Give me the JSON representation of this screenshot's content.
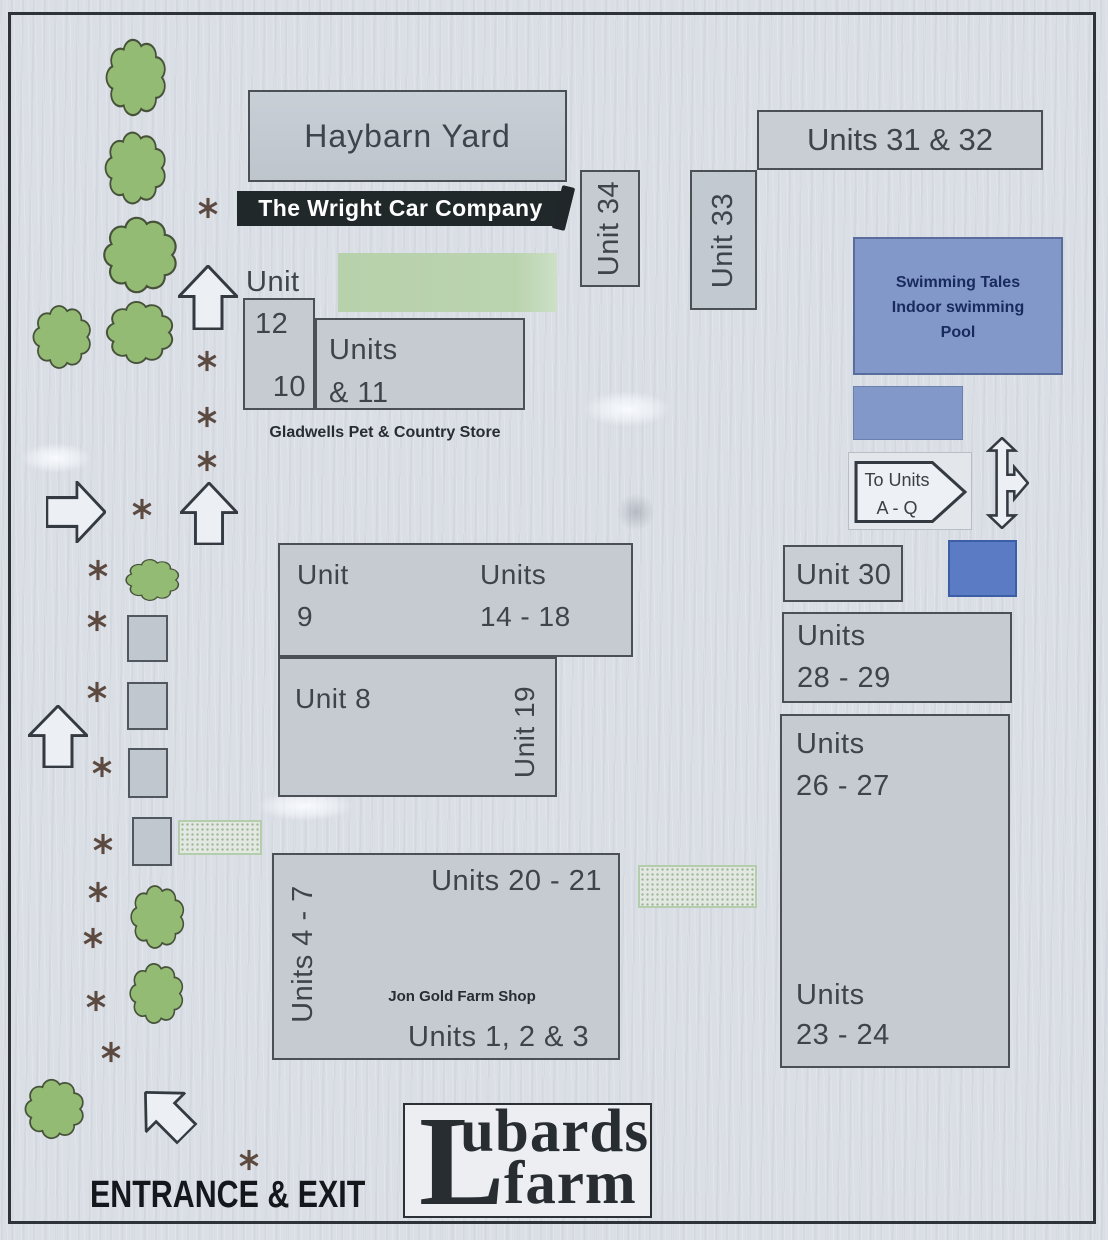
{
  "buildings": {
    "haybarn": {
      "label": "Haybarn Yard"
    },
    "wright_car": {
      "label": "The Wright Car Company"
    },
    "unit12": {
      "title": "Unit",
      "number_top": "12",
      "number_bottom": "10"
    },
    "units10_11": {
      "line1": "Units",
      "line2": "& 11"
    },
    "gladwells": {
      "label": "Gladwells Pet & Country Store"
    },
    "unit34": {
      "label": "Unit 34"
    },
    "unit33": {
      "label": "Unit 33"
    },
    "units31_32": {
      "label": "Units 31 & 32"
    },
    "pool": {
      "line1": "Swimming Tales",
      "line2": "Indoor swimming",
      "line3": "Pool"
    },
    "to_units_sign": {
      "line1": "To Units",
      "line2": "A - Q"
    },
    "unit30": {
      "label": "Unit 30"
    },
    "units28_29": {
      "line1": "Units",
      "line2": "28 - 29"
    },
    "units26_27": {
      "line1": "Units",
      "line2": "26 - 27"
    },
    "units23_24": {
      "line1": "Units",
      "line2": "23 - 24"
    },
    "unit9": {
      "line1": "Unit",
      "line2": "9"
    },
    "units14_18": {
      "line1": "Units",
      "line2": "14 - 18"
    },
    "unit8": {
      "label": "Unit 8"
    },
    "unit19": {
      "label": "Unit 19"
    },
    "units20_21": {
      "label": "Units 20 - 21"
    },
    "units4_7": {
      "label": "Units 4 - 7"
    },
    "jon_gold": {
      "label": "Jon Gold Farm Shop"
    },
    "units1_2_3": {
      "label": "Units 1, 2 & 3"
    },
    "entrance": {
      "label": "ENTRANCE & EXIT"
    },
    "logo": {
      "initial": "L",
      "rest": "ubards",
      "word2": "farm",
      "full_name": "Lubards farm"
    }
  },
  "colors": {
    "background": "#dadee5",
    "box_fill": "#c6cbd2",
    "box_border": "#4a5056",
    "banner_bg": "#212829",
    "banner_text": "#ffffff",
    "green_area": "#b9d3ae",
    "tree_fill": "#93bb74",
    "tree_stroke": "#47523a",
    "pool_fill": "#8298c8",
    "pool_text": "#192a5c",
    "blue_square": "#5b7cc4",
    "blue_box": "#8298c8",
    "asterisk": "#5c4a41",
    "arrow_stroke": "#343a41",
    "arrow_fill": "#eceff3",
    "text": "#3e444b"
  },
  "decorations": {
    "trees": [
      {
        "x": 103,
        "y": 35,
        "w": 67,
        "h": 85
      },
      {
        "x": 102,
        "y": 128,
        "w": 68,
        "h": 80
      },
      {
        "x": 100,
        "y": 213,
        "w": 82,
        "h": 84
      },
      {
        "x": 30,
        "y": 302,
        "w": 65,
        "h": 70
      },
      {
        "x": 103,
        "y": 298,
        "w": 75,
        "h": 69
      },
      {
        "x": 123,
        "y": 557,
        "w": 60,
        "h": 46
      },
      {
        "x": 128,
        "y": 882,
        "w": 60,
        "h": 70
      },
      {
        "x": 127,
        "y": 960,
        "w": 60,
        "h": 67
      },
      {
        "x": 22,
        "y": 1076,
        "w": 66,
        "h": 66
      }
    ],
    "asterisks": [
      {
        "x": 208,
        "y": 208
      },
      {
        "x": 207,
        "y": 361
      },
      {
        "x": 207,
        "y": 417
      },
      {
        "x": 207,
        "y": 461
      },
      {
        "x": 142,
        "y": 509
      },
      {
        "x": 98,
        "y": 570
      },
      {
        "x": 97,
        "y": 621
      },
      {
        "x": 97,
        "y": 692
      },
      {
        "x": 102,
        "y": 767
      },
      {
        "x": 103,
        "y": 844
      },
      {
        "x": 98,
        "y": 892
      },
      {
        "x": 93,
        "y": 938
      },
      {
        "x": 96,
        "y": 1001
      },
      {
        "x": 111,
        "y": 1052
      },
      {
        "x": 249,
        "y": 1160
      }
    ],
    "squares": [
      {
        "x": 127,
        "y": 615,
        "w": 41,
        "h": 47
      },
      {
        "x": 127,
        "y": 682,
        "w": 41,
        "h": 48
      },
      {
        "x": 128,
        "y": 748,
        "w": 40,
        "h": 50
      },
      {
        "x": 132,
        "y": 817,
        "w": 40,
        "h": 49
      }
    ],
    "stipples": [
      {
        "x": 178,
        "y": 820,
        "w": 84,
        "h": 35
      },
      {
        "x": 638,
        "y": 865,
        "w": 119,
        "h": 43
      }
    ],
    "arrows": [
      {
        "type": "up",
        "x": 178,
        "y": 265,
        "w": 60,
        "h": 65,
        "rot": 0
      },
      {
        "type": "up",
        "x": 180,
        "y": 482,
        "w": 58,
        "h": 63,
        "rot": 0
      },
      {
        "type": "up",
        "x": 45,
        "y": 482,
        "w": 62,
        "h": 60,
        "rot": 90
      },
      {
        "type": "up",
        "x": 28,
        "y": 705,
        "w": 60,
        "h": 63,
        "rot": 0
      },
      {
        "type": "up",
        "x": 138,
        "y": 1083,
        "w": 56,
        "h": 60,
        "rot": -45
      },
      {
        "type": "cross",
        "x": 975,
        "y": 437,
        "w": 54,
        "h": 92,
        "rot": 0
      }
    ],
    "smudges": [
      {
        "x": 583,
        "y": 391,
        "w": 88,
        "h": 36,
        "tone": "light"
      },
      {
        "x": 610,
        "y": 486,
        "w": 52,
        "h": 52,
        "tone": "dark"
      },
      {
        "x": 256,
        "y": 791,
        "w": 98,
        "h": 30,
        "tone": "light"
      },
      {
        "x": 20,
        "y": 443,
        "w": 72,
        "h": 30,
        "tone": "light"
      },
      {
        "x": 557,
        "y": 186,
        "w": 13,
        "h": 44,
        "tone": "ink"
      }
    ]
  }
}
